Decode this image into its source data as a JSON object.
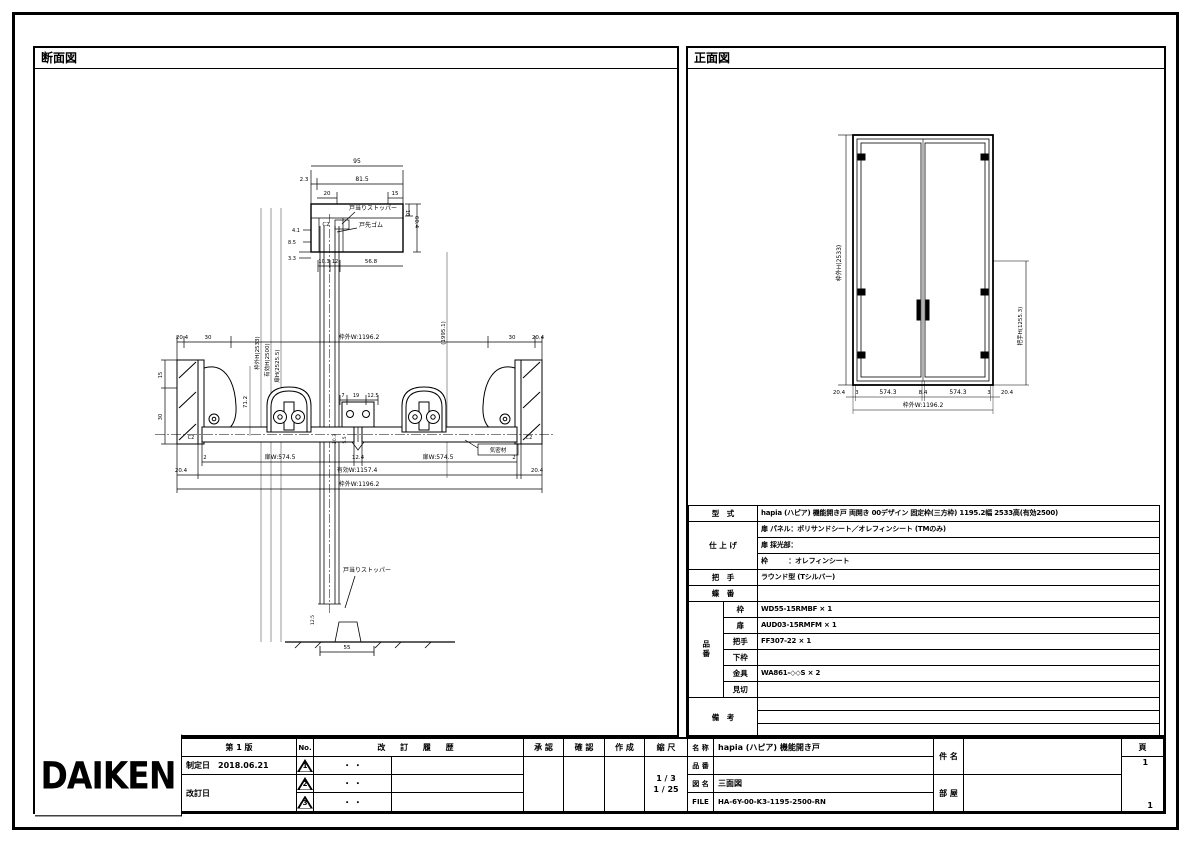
{
  "titles": {
    "section": "断面図",
    "front": "正面図"
  },
  "logo": "DAIKEN",
  "revision_block": {
    "edition": "第 1 版",
    "enacted_label": "制定日",
    "enacted_date": "2018.06.21",
    "revised_label": "改訂日",
    "no_header": "No.",
    "history_header": "改 訂 履 歴",
    "rows": [
      {
        "no": "1",
        "date": "・ ・",
        "desc": ""
      },
      {
        "no": "2",
        "date": "・ ・",
        "desc": ""
      },
      {
        "no": "3",
        "date": "・ ・",
        "desc": ""
      }
    ]
  },
  "approval": {
    "approve": "承 認",
    "check": "確 認",
    "create": "作 成",
    "scale_label": "縮 尺",
    "scale1": "1 / 3",
    "scale2": "1 / 25"
  },
  "doc_block": {
    "name_label": "名 称",
    "name": "hapia (ハピア)  機能開き戸",
    "pn_label": "品 番",
    "pn": "",
    "drawing_label": "図 名",
    "drawing": "三面図",
    "file_label": "FILE",
    "file": "HA-6Y-00-K3-1195-2500-RN",
    "project_label": "件 名",
    "project": "",
    "room_label": "部 屋",
    "room": "",
    "page_label": "頁",
    "page_top": "1",
    "page_bottom": "1"
  },
  "spec": {
    "model_label": "型　式",
    "model": "hapia (ハピア)  機能開き戸 両開き 00デザイン 固定枠(三方枠) 1195.2幅 2533高(有効2500)",
    "finish_label": "仕 上 げ",
    "finish_line1": "扉 パネル：ポリサンドシート／オレフィンシート (TMのみ)",
    "finish_line2": "扉 採光部：",
    "finish_line3": "枠　　　：オレフィンシート",
    "handle_label": "把　手",
    "handle": "ラウンド型 (Tシルバー)",
    "hinge_label": "蝶　番",
    "hinge": "",
    "parts_label": "品番",
    "parts": [
      {
        "k": "枠",
        "v": "WD55-15RMBF × 1"
      },
      {
        "k": "扉",
        "v": "AUD03-15RMFM × 1"
      },
      {
        "k": "把手",
        "v": "FF307-22 × 1"
      },
      {
        "k": "下枠",
        "v": ""
      },
      {
        "k": "金具",
        "v": "WA861-◇◇S × 2"
      },
      {
        "k": "見切",
        "v": ""
      }
    ],
    "notes_label": "備　考",
    "notes": [
      "",
      "",
      ""
    ]
  },
  "section_view": {
    "annotations": [
      {
        "t": "95",
        "x": 322,
        "y": 115,
        "s": 6
      },
      {
        "t": "2.3",
        "x": 269,
        "y": 133,
        "s": 5.5
      },
      {
        "t": "81.5",
        "x": 327,
        "y": 133,
        "s": 6
      },
      {
        "t": "20",
        "x": 292,
        "y": 147,
        "s": 5.5
      },
      {
        "t": "15",
        "x": 360,
        "y": 147,
        "s": 5.5
      },
      {
        "t": "C2",
        "x": 291,
        "y": 178,
        "s": 5.5
      },
      {
        "t": "戸当りストッパー",
        "x": 338,
        "y": 162,
        "s": 6
      },
      {
        "t": "戸先ゴム",
        "x": 336,
        "y": 179,
        "s": 6
      },
      {
        "t": "4.1",
        "x": 261,
        "y": 184,
        "s": 5
      },
      {
        "t": "8.5",
        "x": 257,
        "y": 196,
        "s": 5
      },
      {
        "t": "3.3",
        "x": 257,
        "y": 212,
        "s": 5
      },
      {
        "t": "10.3",
        "x": 289,
        "y": 215,
        "s": 5
      },
      {
        "t": "12",
        "x": 300,
        "y": 215,
        "s": 5
      },
      {
        "t": "56.8",
        "x": 336,
        "y": 215,
        "s": 5.5
      },
      {
        "t": "10",
        "x": 371,
        "y": 165,
        "r": 90,
        "s": 5
      },
      {
        "t": "60.4",
        "x": 380,
        "y": 174,
        "r": 90,
        "s": 5.5
      },
      {
        "t": "枠外H(2533)",
        "x": 224,
        "y": 305,
        "r": -90,
        "s": 5.5
      },
      {
        "t": "有効H(2500)",
        "x": 234,
        "y": 312,
        "r": -90,
        "s": 5.5
      },
      {
        "t": "扉H(2525.5)",
        "x": 244,
        "y": 318,
        "r": -90,
        "s": 5.5
      },
      {
        "t": "(1995.1)",
        "x": 410,
        "y": 285,
        "r": -90,
        "s": 5.5
      },
      {
        "t": "20.4",
        "x": 147,
        "y": 291,
        "s": 5.5
      },
      {
        "t": "30",
        "x": 173,
        "y": 291,
        "s": 5.5
      },
      {
        "t": "枠外W:1196.2",
        "x": 324,
        "y": 291,
        "s": 6
      },
      {
        "t": "30",
        "x": 477,
        "y": 291,
        "s": 5.5
      },
      {
        "t": "20.4",
        "x": 503,
        "y": 291,
        "s": 5.5
      },
      {
        "t": "15",
        "x": 127,
        "y": 327,
        "r": -90,
        "s": 5
      },
      {
        "t": "30",
        "x": 127,
        "y": 369,
        "r": -90,
        "s": 5
      },
      {
        "t": "71.2",
        "x": 212,
        "y": 354,
        "r": -90,
        "s": 5.5
      },
      {
        "t": "7",
        "x": 308,
        "y": 349,
        "s": 5
      },
      {
        "t": "19",
        "x": 321,
        "y": 349,
        "s": 5
      },
      {
        "t": "12.5",
        "x": 338,
        "y": 349,
        "s": 5
      },
      {
        "t": "10.3",
        "x": 301,
        "y": 391,
        "r": -90,
        "s": 4.5
      },
      {
        "t": "5.5",
        "x": 311,
        "y": 392,
        "r": -90,
        "s": 4.5
      },
      {
        "t": "C2",
        "x": 156,
        "y": 391,
        "s": 5
      },
      {
        "t": "C2",
        "x": 494,
        "y": 391,
        "s": 5
      },
      {
        "t": "気密材",
        "x": 463,
        "y": 404,
        "s": 5.5
      },
      {
        "t": "2",
        "x": 170,
        "y": 411,
        "s": 5
      },
      {
        "t": "扉W:574.5",
        "x": 245,
        "y": 411,
        "s": 6
      },
      {
        "t": "12.4",
        "x": 323,
        "y": 411,
        "s": 5.5
      },
      {
        "t": "扉W:574.5",
        "x": 403,
        "y": 411,
        "s": 6
      },
      {
        "t": "2",
        "x": 479,
        "y": 411,
        "s": 5
      },
      {
        "t": "20.4",
        "x": 146,
        "y": 424,
        "s": 5.5
      },
      {
        "t": "有効W:1157.4",
        "x": 322,
        "y": 424,
        "s": 6
      },
      {
        "t": "20.4",
        "x": 502,
        "y": 424,
        "s": 5.5
      },
      {
        "t": "枠外W:1196.2",
        "x": 324,
        "y": 438,
        "s": 6
      },
      {
        "t": "戸当りストッパー",
        "x": 332,
        "y": 524,
        "s": 6
      },
      {
        "t": "12.5",
        "x": 279,
        "y": 572,
        "r": -90,
        "s": 4.5
      },
      {
        "t": "55",
        "x": 312,
        "y": 601,
        "s": 5.5
      }
    ]
  },
  "front_view": {
    "annotations": [
      {
        "t": "枠外H(2533)",
        "x": 153,
        "y": 215,
        "r": -90,
        "s": 6
      },
      {
        "t": "把手H(1255.3)",
        "x": 334,
        "y": 278,
        "r": -90,
        "s": 5.5
      },
      {
        "t": "20.4",
        "x": 151,
        "y": 346,
        "s": 5.5
      },
      {
        "t": "3",
        "x": 169,
        "y": 346,
        "s": 5
      },
      {
        "t": "574.3",
        "x": 200,
        "y": 346,
        "s": 6
      },
      {
        "t": "8.4",
        "x": 235,
        "y": 346,
        "s": 5.5
      },
      {
        "t": "574.3",
        "x": 270,
        "y": 346,
        "s": 6
      },
      {
        "t": "3",
        "x": 301,
        "y": 346,
        "s": 5
      },
      {
        "t": "20.4",
        "x": 319,
        "y": 346,
        "s": 5.5
      },
      {
        "t": "枠外W:1196.2",
        "x": 235,
        "y": 359,
        "s": 6
      }
    ]
  }
}
